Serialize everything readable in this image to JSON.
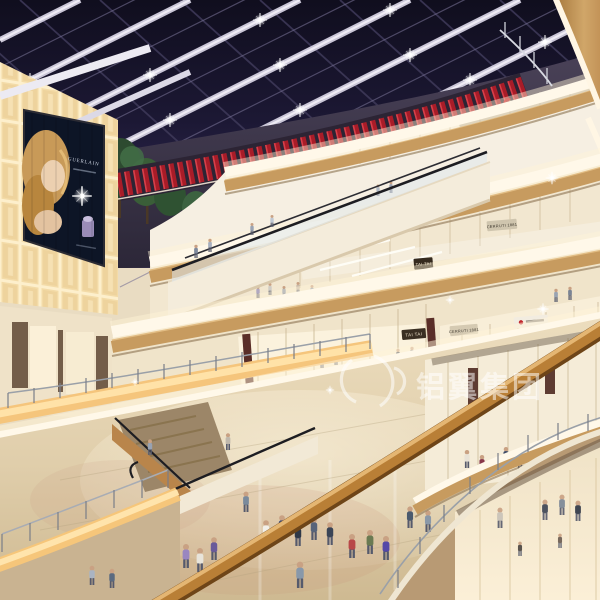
{
  "scene": {
    "description": "Multi-level shopping mall atrium at night, architectural rendering",
    "signs": {
      "theatres": "THEATRES",
      "tai_tai_upper": "TAI TAI",
      "tai_tai_lower": "TAI TAI",
      "cerruti_upper": "CERRUTI 1881",
      "cerruti_lower": "CERRUTI 1881"
    },
    "ad_screen": {
      "brand": "GUERLAIN"
    },
    "watermark": {
      "text": "铝翼集团"
    },
    "colors": {
      "night_sky": "#1c1834",
      "theatre_red": "#c5101c",
      "wood": "#c79b5f",
      "fascia_glow": "#fff8e9",
      "floor": "#ddcbaa",
      "balustrade_glow": "#f6c67a"
    }
  }
}
